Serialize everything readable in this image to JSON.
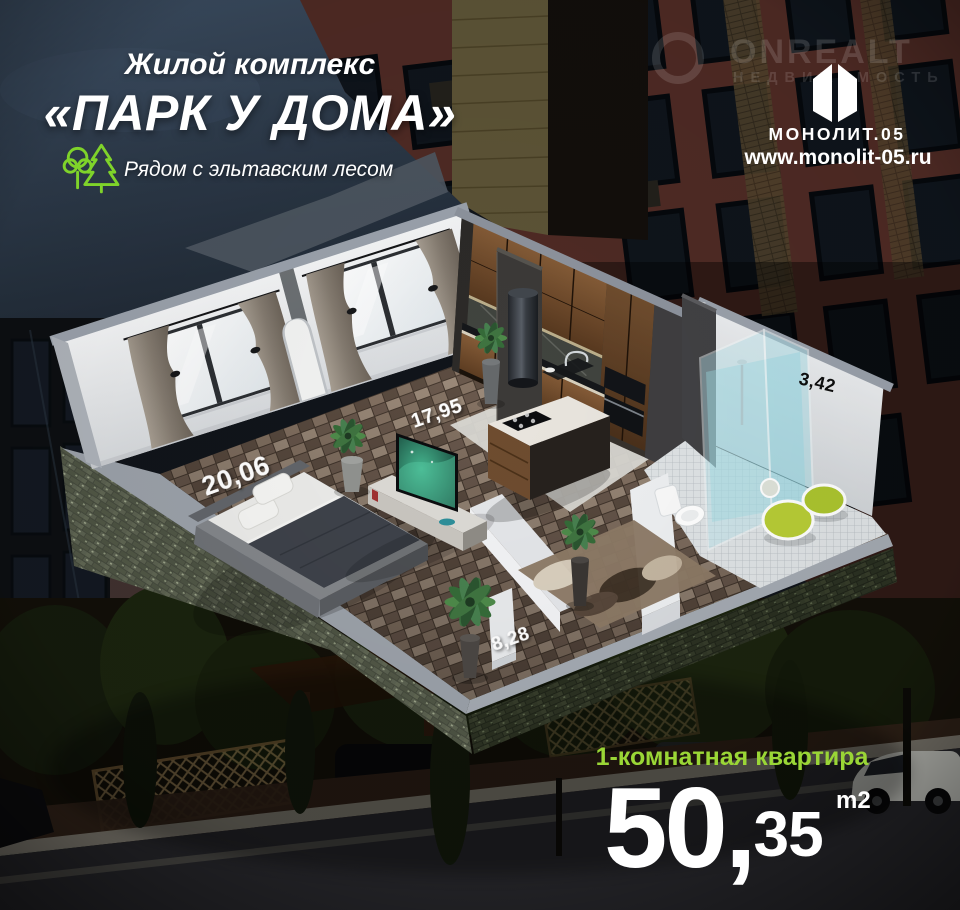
{
  "header": {
    "complex_label": "Жилой комплекс",
    "complex_name": "«ПАРК У ДОМА»",
    "tagline": "Рядом с эльтавским лесом"
  },
  "watermark": {
    "brand": "ONREALT",
    "caption": "НЕДВИЖИМОСТЬ"
  },
  "developer": {
    "name": "МОНОЛИТ.05",
    "website": "www.monolit-05.ru"
  },
  "floorplan": {
    "labels": {
      "bedroom": "20,06",
      "living": "17,95",
      "hallway": "8,28",
      "bathroom": "3,42"
    }
  },
  "offer": {
    "type": "1-комнатная квартира",
    "area_int": "50",
    "area_comma": ",",
    "area_frac": "35",
    "area_unit": "m2"
  },
  "colors": {
    "accent_green": "#9ad636",
    "icon_green": "#7fd32a",
    "sky_navy": "#3b4c60",
    "wall_white": "#eef0f2",
    "brick_red": "#4e2a24"
  }
}
